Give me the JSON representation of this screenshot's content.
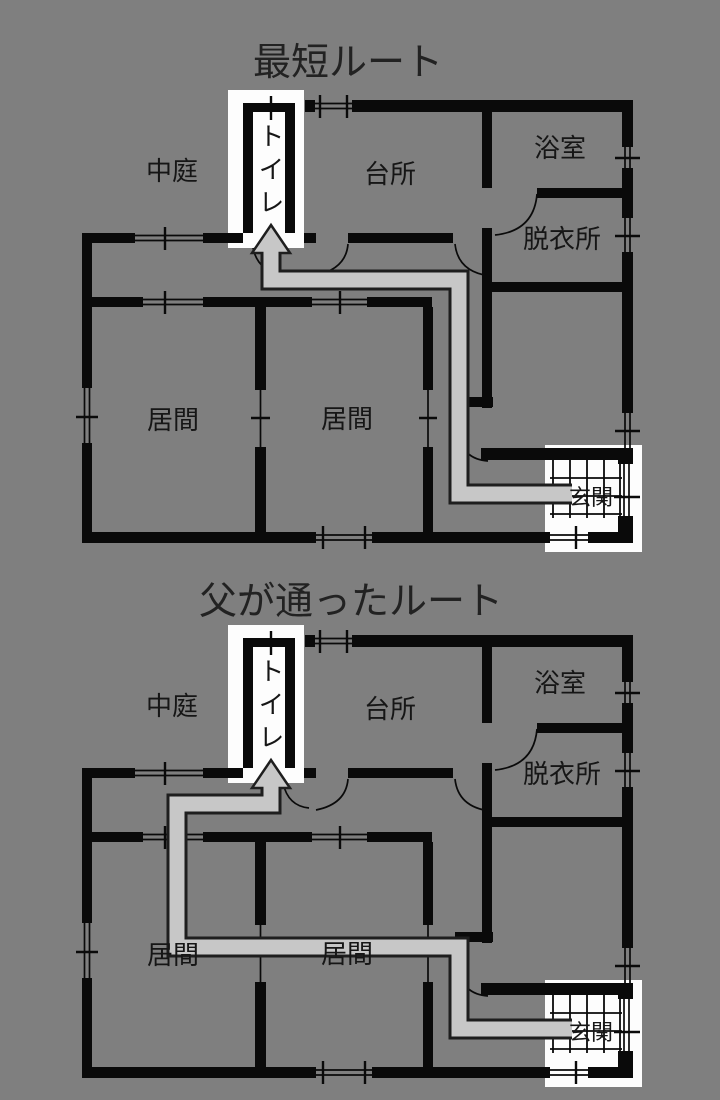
{
  "plans": [
    {
      "title": "最短ルート"
    },
    {
      "title": "父が通ったルート"
    }
  ],
  "rooms": {
    "courtyard": "中庭",
    "toilet": "トイレ",
    "kitchen": "台所",
    "bath": "浴室",
    "dressing": "脱衣所",
    "living": "居間",
    "entrance": "玄関"
  },
  "colors": {
    "background": "#7f7f7f",
    "wall": "#0a0a0a",
    "route": "#c7c7c7",
    "route_outline": "#1e1e1e",
    "floor_white": "#fdfdfd",
    "text": "#161616"
  }
}
